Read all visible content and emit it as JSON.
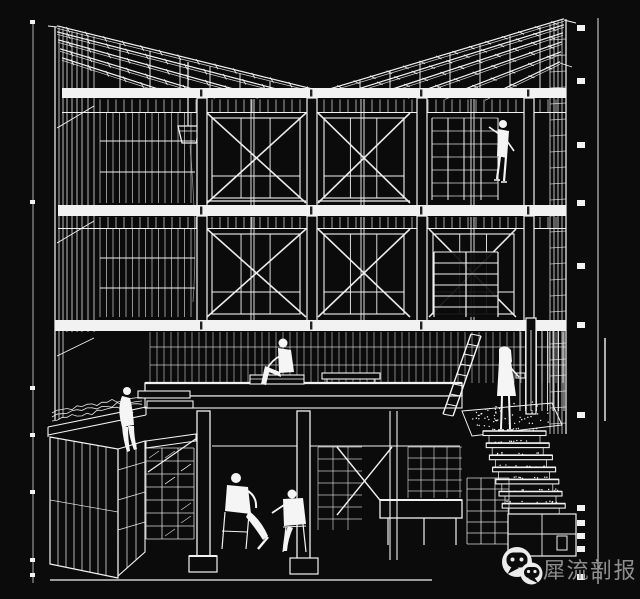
{
  "watermark": {
    "label": "犀流剖报",
    "icon": "wechat-logo"
  },
  "colors": {
    "background": "#0b0b0b",
    "line": "#f2f2f2",
    "line_dim": "#bdbdbd",
    "figure_fill": "#f5f5f5",
    "watermark_icon": "#ececec",
    "watermark_text": "#8e8e8e"
  }
}
